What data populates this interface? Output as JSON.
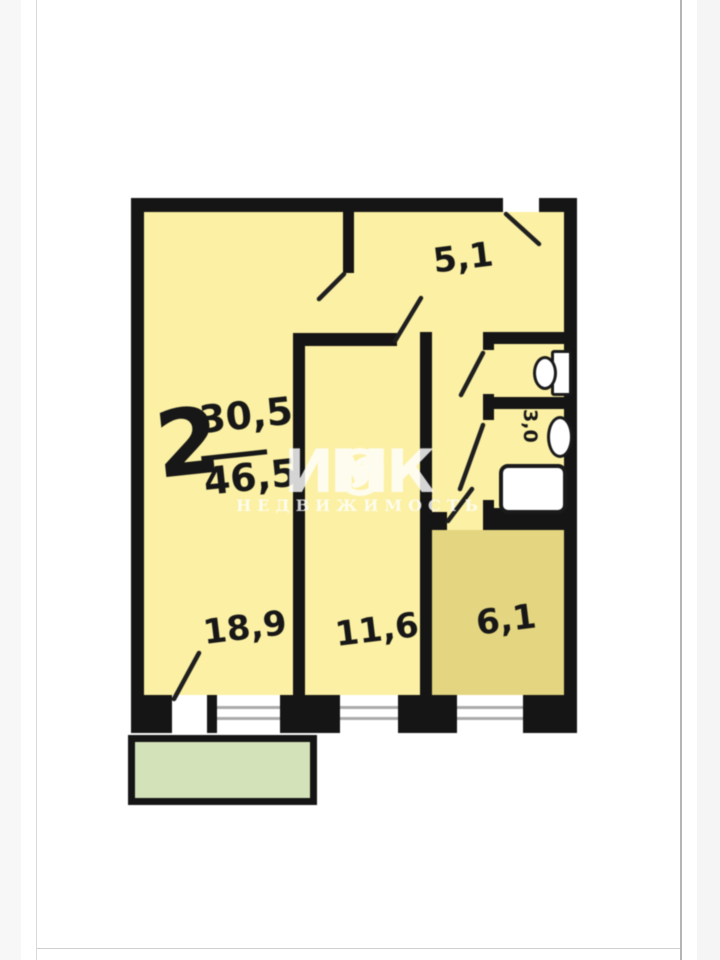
{
  "floorplan": {
    "apartment_type": {
      "rooms_count": "2",
      "living_area": "30,5",
      "total_area": "46,5"
    },
    "rooms": {
      "hallway": {
        "label": "5,1"
      },
      "living_room": {
        "label": "18,9"
      },
      "bedroom": {
        "label": "11,6"
      },
      "kitchen": {
        "label": "6,1"
      },
      "bathroom": {
        "label": "3,0"
      }
    },
    "fixtures": [
      "toilet",
      "sink",
      "bathtub"
    ],
    "colors": {
      "room_fill": "#FBF0A3",
      "kitchen_fill": "#E4D580",
      "balcony_fill": "#D3E2B8",
      "wall": "#151515"
    }
  },
  "watermark": {
    "brand_part1": "ИНК",
    "brand_part2": "М",
    "subtitle": "НЕДВИЖИМОСТЬ"
  }
}
